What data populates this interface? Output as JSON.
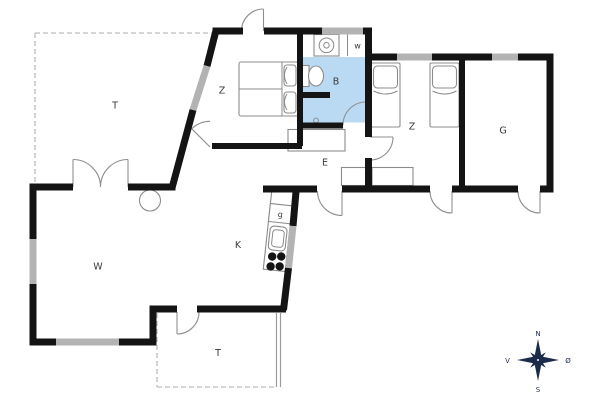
{
  "colors": {
    "wall": "#141414",
    "bathroom_fill": "#badaf4",
    "window_gray": "#b3b3b3",
    "furniture_line": "#8c8c8c",
    "dashed_line": "#bdbdbd",
    "compass_navy": "#1c2b4a",
    "label_color": "#3a3a3a"
  },
  "plan": {
    "rooms": {
      "terrace_top": {
        "label": "T"
      },
      "bedroom_double": {
        "label": "Z"
      },
      "bathroom": {
        "label": "B"
      },
      "bedroom_twin": {
        "label": "Z"
      },
      "room_g": {
        "label": "G"
      },
      "hallway": {
        "label": "E"
      },
      "living_room": {
        "label": "W"
      },
      "kitchen": {
        "label": "K"
      },
      "terrace_bottom": {
        "label": "T"
      }
    },
    "appliances": {
      "washing_machine": {
        "label": "w"
      },
      "dishwasher": {
        "label": "g"
      }
    },
    "compass": {
      "north": "N",
      "south": "S",
      "west": "V",
      "east": "Ø"
    }
  }
}
